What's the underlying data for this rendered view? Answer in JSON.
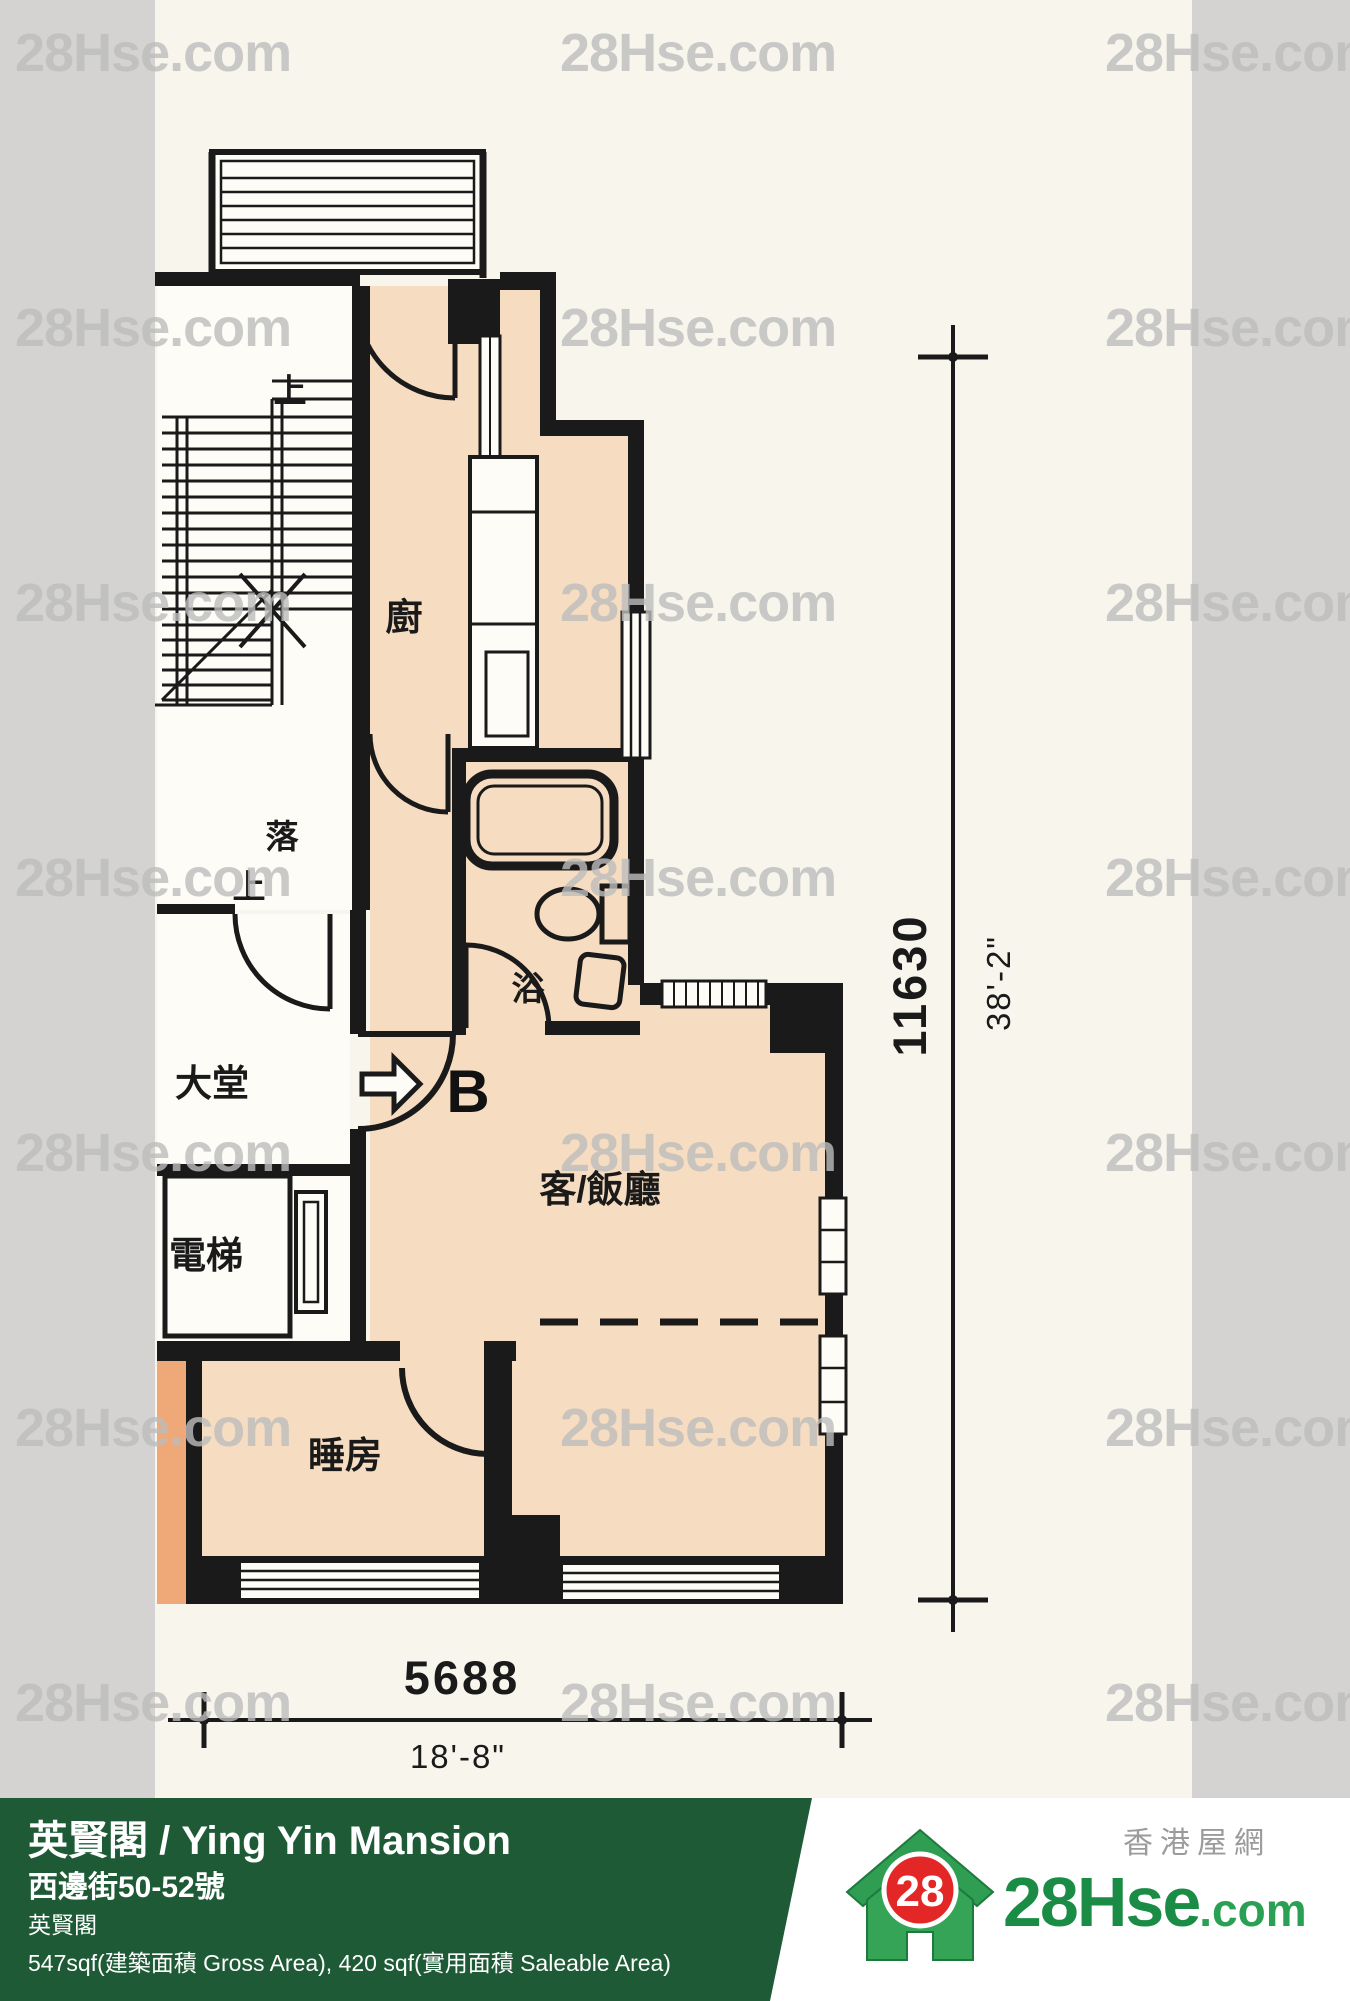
{
  "watermark": {
    "text": "28Hse.com"
  },
  "plan": {
    "rooms": {
      "stairs_up_top": "上",
      "stairs_down": "落",
      "stairs_up_lower": "上",
      "kitchen": "廚",
      "bath": "浴",
      "lobby": "大堂",
      "elevator": "電梯",
      "living_dining": "客/飯廳",
      "bedroom": "睡房",
      "unit": "B"
    },
    "dimensions": {
      "height_mm": "11630",
      "height_ft": "38'-2\"",
      "width_mm": "5688",
      "width_ft": "18'-8\""
    }
  },
  "footer": {
    "title": "英賢閣 / Ying Yin Mansion",
    "address": "西邊街50-52號",
    "building": "英賢閣",
    "area": "547sqf(建築面積 Gross Area), 420 sqf(實用面積 Saleable Area)"
  },
  "logo": {
    "badge": "28",
    "brand": "28Hse",
    "brand_suffix": ".com",
    "tagline": "香港屋網"
  },
  "colors": {
    "wall": "#1a1a1a",
    "unit_floor": "#f6dcc1",
    "adjacent_unit": "#efa878",
    "room_white": "#fdfcf6",
    "watermark_gray": "#bdbdbd",
    "footer_green": "#1e5a36",
    "brand_green": "#1b8c45",
    "badge_red": "#e32726",
    "side_band_gray": "#d4d3d1"
  }
}
